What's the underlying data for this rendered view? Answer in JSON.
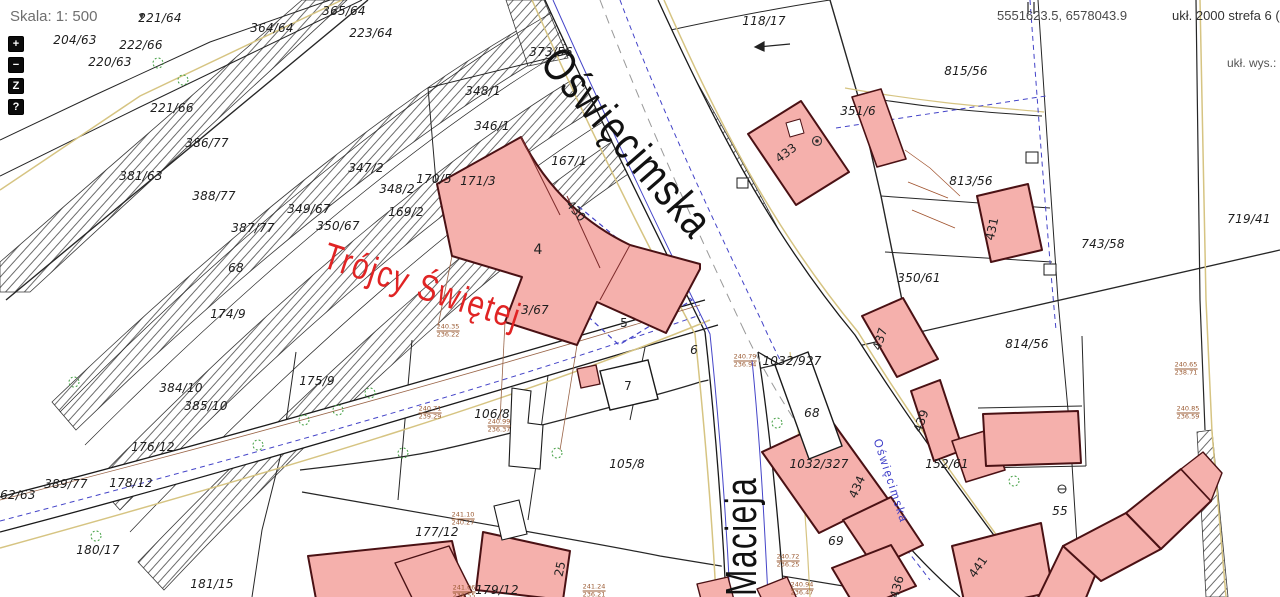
{
  "ui": {
    "scale": {
      "label": "Skala:",
      "value": "1: 500",
      "dropdown_icon": "▼"
    },
    "toolbar": [
      {
        "id": "zoom-in",
        "label": "+"
      },
      {
        "id": "zoom-out",
        "label": "−"
      },
      {
        "id": "zoom-extent",
        "label": "Z"
      },
      {
        "id": "help",
        "label": "?"
      }
    ],
    "coordinates": "5551623.5, 6578043.9",
    "crs": "ukł. 2000 strefa 6 (18",
    "crs_height": "ukł. wys.: B"
  },
  "map": {
    "colors": {
      "building_fill": "#f5b0ac",
      "building_stroke": "#4a1114",
      "street_text": "#111111",
      "trojcy_text": "#e02424",
      "utility_blue": "#4444c8",
      "utility_tan": "#d6c482",
      "utility_brown": "#9a6548",
      "tree_green": "#3f9d3f"
    },
    "street_names": [
      {
        "text": "Oświęcimska",
        "x": 571,
        "y": 36,
        "rot": 49,
        "sx": 0.8,
        "size": 46,
        "color": "#111111",
        "org": "tl",
        "name": "street-name-oswiecimska"
      },
      {
        "text": "Macieja",
        "x": 717,
        "y": 596,
        "rot": -90,
        "sx": 0.72,
        "size": 44,
        "color": "#111111",
        "org": "tl",
        "name": "street-name-macieja"
      },
      {
        "text": "Trójcy Świętej",
        "x": 331,
        "y": 235,
        "rot": 18,
        "sx": 0.8,
        "size": 37,
        "color": "#e02424",
        "org": "tl",
        "name": "street-name-trojcy-swietej"
      },
      {
        "text": "Oświęcimska",
        "x": 884,
        "y": 437,
        "rot": 72,
        "sx": 0.95,
        "size": 12,
        "color": "#3c3cc8",
        "org": "tl",
        "name": "street-label-oswiecimska-small"
      }
    ],
    "parcel_labels": [
      {
        "text": "204/63",
        "x": 75,
        "y": 40
      },
      {
        "text": "222/66",
        "x": 141,
        "y": 45
      },
      {
        "text": "220/63",
        "x": 110,
        "y": 62
      },
      {
        "text": "221/64",
        "x": 160,
        "y": 18
      },
      {
        "text": "221/66",
        "x": 172,
        "y": 108
      },
      {
        "text": "364/64",
        "x": 272,
        "y": 28
      },
      {
        "text": "365/64",
        "x": 344,
        "y": 11
      },
      {
        "text": "223/64",
        "x": 371,
        "y": 33
      },
      {
        "text": "386/77",
        "x": 207,
        "y": 143
      },
      {
        "text": "381/63",
        "x": 141,
        "y": 176
      },
      {
        "text": "388/77",
        "x": 214,
        "y": 196
      },
      {
        "text": "387/77",
        "x": 253,
        "y": 228
      },
      {
        "text": "349/67",
        "x": 309,
        "y": 209
      },
      {
        "text": "350/67",
        "x": 338,
        "y": 226
      },
      {
        "text": "347/2",
        "x": 366,
        "y": 168
      },
      {
        "text": "348/2",
        "x": 397,
        "y": 189
      },
      {
        "text": "170/5",
        "x": 434,
        "y": 179
      },
      {
        "text": "171/3",
        "x": 478,
        "y": 181
      },
      {
        "text": "169/2",
        "x": 406,
        "y": 212
      },
      {
        "text": "348/1",
        "x": 483,
        "y": 91
      },
      {
        "text": "346/1",
        "x": 492,
        "y": 126
      },
      {
        "text": "373/56",
        "x": 551,
        "y": 52
      },
      {
        "text": "167/1",
        "x": 569,
        "y": 161
      },
      {
        "text": "118/17",
        "x": 764,
        "y": 21
      },
      {
        "text": "815/56",
        "x": 966,
        "y": 71
      },
      {
        "text": "351/6",
        "x": 858,
        "y": 111
      },
      {
        "text": "813/56",
        "x": 971,
        "y": 181
      },
      {
        "text": "350/61",
        "x": 919,
        "y": 278
      },
      {
        "text": "743/58",
        "x": 1103,
        "y": 244
      },
      {
        "text": "719/41",
        "x": 1249,
        "y": 219
      },
      {
        "text": "814/56",
        "x": 1027,
        "y": 344
      },
      {
        "text": "174/9",
        "x": 228,
        "y": 314
      },
      {
        "text": "68",
        "x": 236,
        "y": 268
      },
      {
        "text": "175/9",
        "x": 317,
        "y": 381
      },
      {
        "text": "384/10",
        "x": 181,
        "y": 388
      },
      {
        "text": "385/10",
        "x": 206,
        "y": 406
      },
      {
        "text": "176/12",
        "x": 153,
        "y": 447
      },
      {
        "text": "178/12",
        "x": 131,
        "y": 483
      },
      {
        "text": "389/77",
        "x": 66,
        "y": 484
      },
      {
        "text": "362/63",
        "x": 14,
        "y": 495
      },
      {
        "text": "180/17",
        "x": 98,
        "y": 550
      },
      {
        "text": "181/15",
        "x": 212,
        "y": 584
      },
      {
        "text": "177/12",
        "x": 437,
        "y": 532
      },
      {
        "text": "179/12",
        "x": 497,
        "y": 590
      },
      {
        "text": "106/8",
        "x": 492,
        "y": 414
      },
      {
        "text": "105/8",
        "x": 627,
        "y": 464
      },
      {
        "text": "3/67",
        "x": 535,
        "y": 310
      },
      {
        "text": "1032/927",
        "x": 792,
        "y": 361
      },
      {
        "text": "1032/327",
        "x": 819,
        "y": 464
      },
      {
        "text": "152/61",
        "x": 947,
        "y": 464
      },
      {
        "text": "68",
        "x": 812,
        "y": 413
      },
      {
        "text": "69",
        "x": 836,
        "y": 541
      },
      {
        "text": "55",
        "x": 1060,
        "y": 511
      },
      {
        "text": "6",
        "x": 694,
        "y": 350
      }
    ],
    "building_labels": [
      {
        "text": "430",
        "x": 576,
        "y": 211,
        "rot": 50
      },
      {
        "text": "4",
        "x": 538,
        "y": 250,
        "size": 14
      },
      {
        "text": "5",
        "x": 624,
        "y": 323
      },
      {
        "text": "7",
        "x": 628,
        "y": 386
      },
      {
        "text": "25",
        "x": 560,
        "y": 569,
        "rot": -78
      },
      {
        "text": "433",
        "x": 786,
        "y": 153,
        "rot": -37
      },
      {
        "text": "431",
        "x": 992,
        "y": 229,
        "rot": -78
      },
      {
        "text": "437",
        "x": 880,
        "y": 339,
        "rot": -72
      },
      {
        "text": "439",
        "x": 921,
        "y": 421,
        "rot": -70
      },
      {
        "text": "434",
        "x": 857,
        "y": 487,
        "rot": -66
      },
      {
        "text": "436",
        "x": 897,
        "y": 587,
        "rot": -75
      },
      {
        "text": "441",
        "x": 978,
        "y": 567,
        "rot": -55
      }
    ],
    "elevation_labels": [
      {
        "top": "240.35",
        "bottom": "236.22",
        "x": 448,
        "y": 331
      },
      {
        "top": "240.71",
        "bottom": "239.29",
        "x": 430,
        "y": 413
      },
      {
        "top": "240.99",
        "bottom": "236.37",
        "x": 499,
        "y": 426
      },
      {
        "top": "241.10",
        "bottom": "240.27",
        "x": 463,
        "y": 519
      },
      {
        "top": "241.06",
        "bottom": "238.55",
        "x": 464,
        "y": 592
      },
      {
        "top": "241.24",
        "bottom": "236.21",
        "x": 594,
        "y": 591
      },
      {
        "top": "240.79",
        "bottom": "236.94",
        "x": 745,
        "y": 361
      },
      {
        "top": "240.72",
        "bottom": "236.25",
        "x": 788,
        "y": 561
      },
      {
        "top": "240.94",
        "bottom": "236.47",
        "x": 802,
        "y": 589
      },
      {
        "top": "240.65",
        "bottom": "238.71",
        "x": 1186,
        "y": 369
      },
      {
        "top": "240.85",
        "bottom": "236.59",
        "x": 1188,
        "y": 413
      }
    ]
  }
}
